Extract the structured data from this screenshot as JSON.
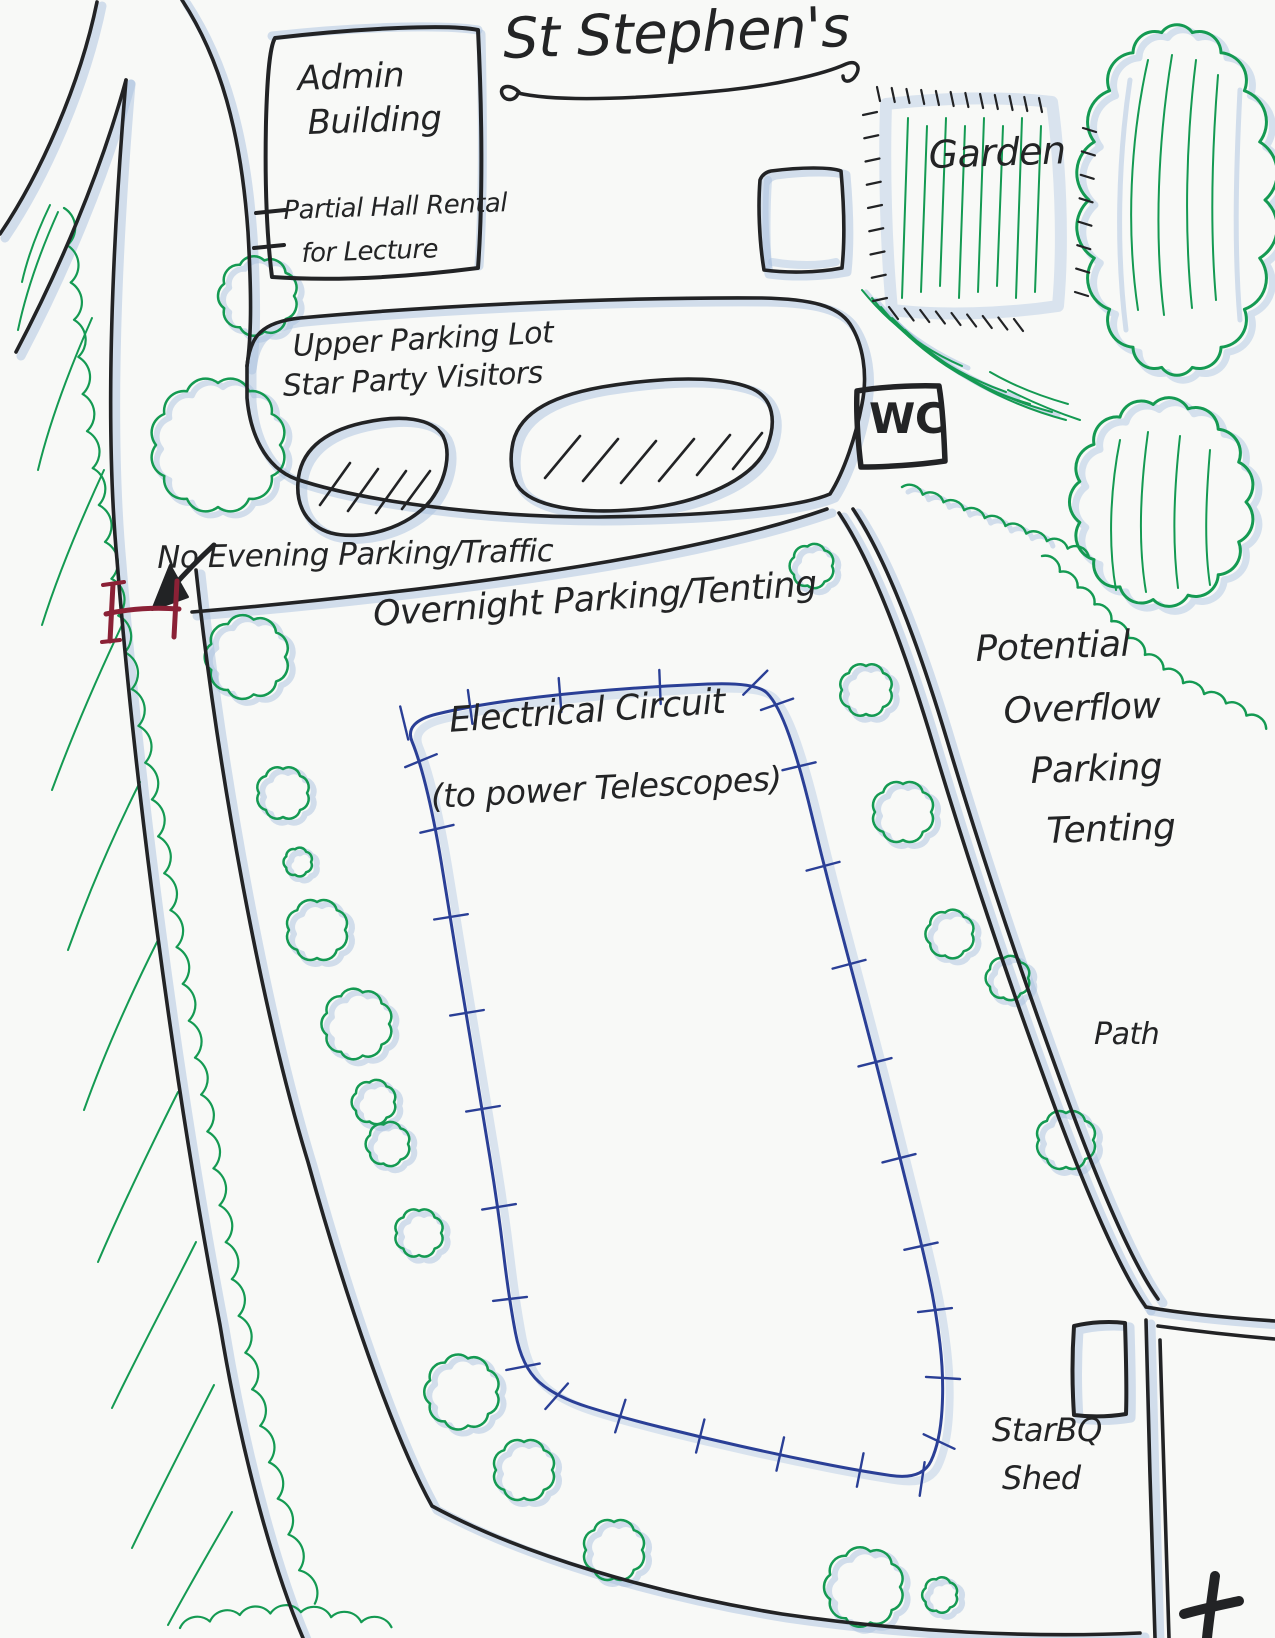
{
  "page": {
    "title": "St Stephen's"
  },
  "colors": {
    "paper": "#f8f9f7",
    "ink": "#222325",
    "green": "#149a52",
    "shade_blue": "#a9c2e0",
    "circuit_blue": "#2a3f96",
    "gate_red": "#8b2136"
  },
  "labels": {
    "admin_building": {
      "line1": "Admin",
      "line2": "Building",
      "note_line1": "Partial Hall Rental",
      "note_line2": "for Lecture"
    },
    "garden": "Garden",
    "upper_lot": {
      "line1": "Upper Parking Lot",
      "line2": "Star Party Visitors"
    },
    "wc": "WC",
    "no_evening": "No Evening Parking/Traffic",
    "overnight": "Overnight Parking/Tenting",
    "electrical": {
      "line1": "Electrical Circuit",
      "line2": "(to power Telescopes)"
    },
    "overflow": {
      "line1": "Potential",
      "line2": "Overflow",
      "line3": "Parking",
      "line4": "Tenting"
    },
    "path": "Path",
    "shed": {
      "line1": "StarBQ",
      "line2": "Shed"
    }
  },
  "icons": {
    "gate": "road-gate-icon",
    "gate_arrow": "gate-arrow-icon",
    "cross": "church-cross-icon"
  }
}
